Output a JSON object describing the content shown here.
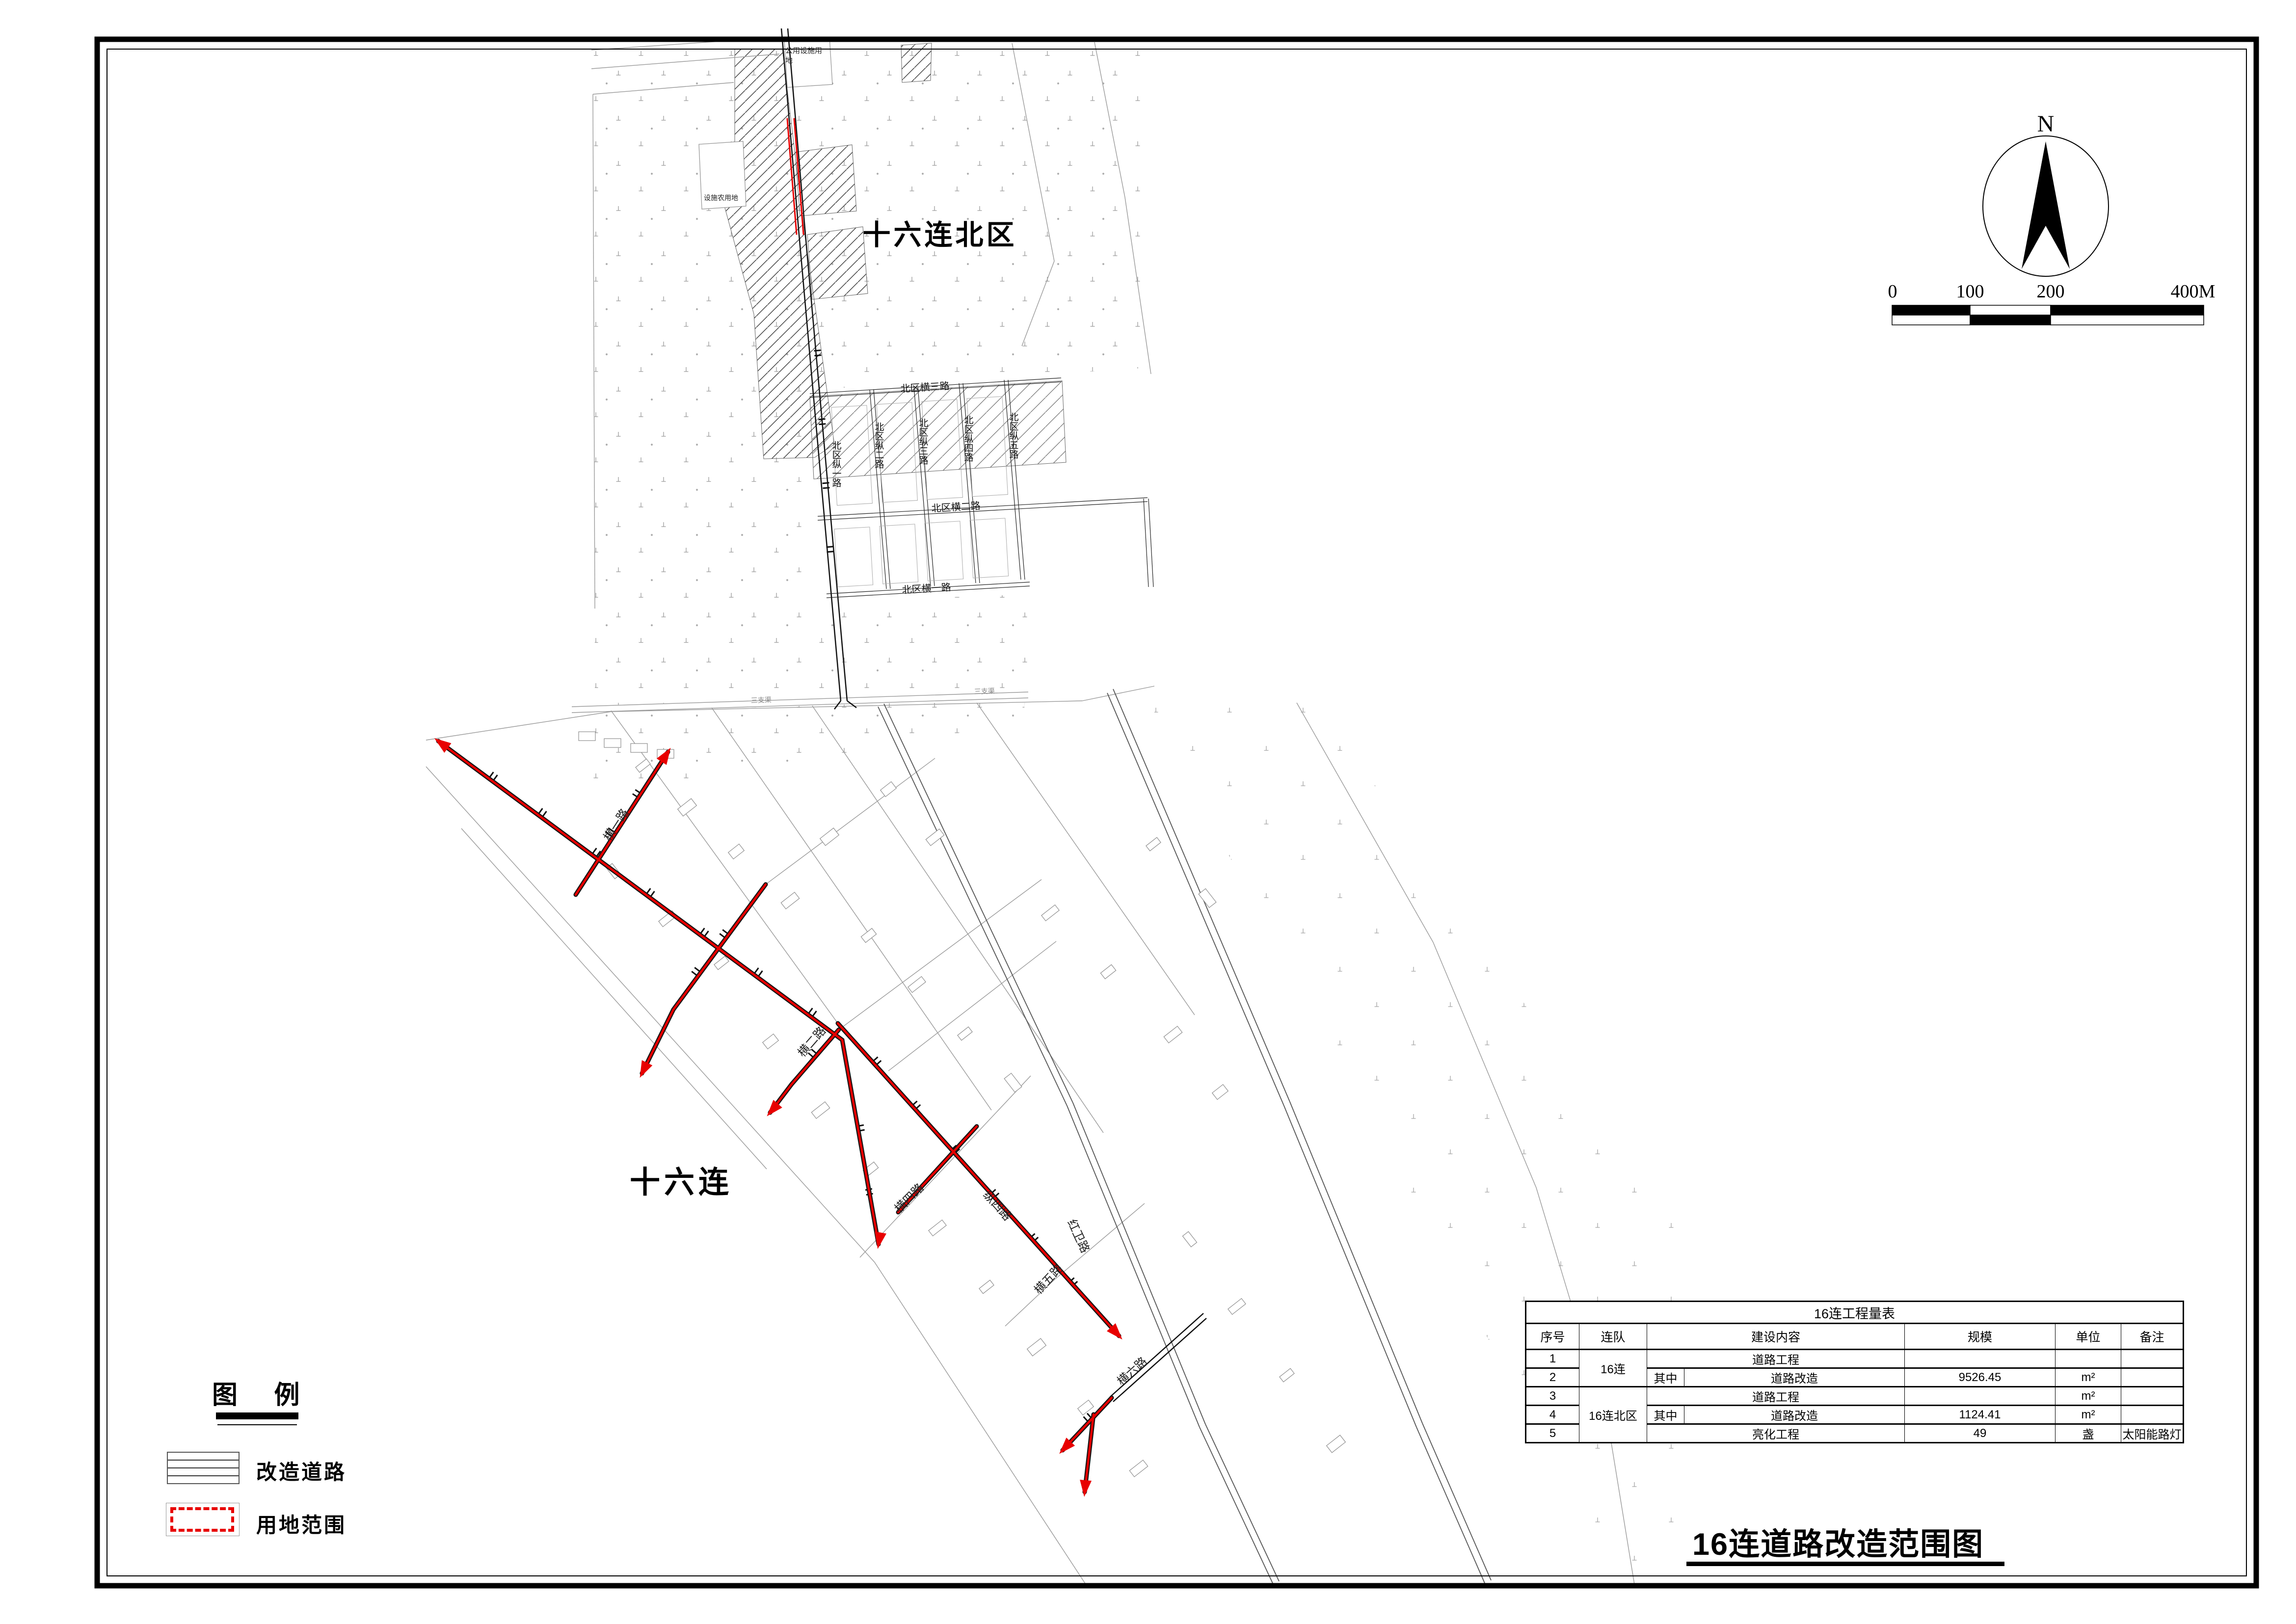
{
  "drawing": {
    "title": "16连道路改造范围图",
    "compass_n": "N",
    "scale_bar": {
      "ticks": [
        "0",
        "100",
        "200",
        "400M"
      ]
    },
    "region_labels": {
      "north_district": "十六连北区",
      "company": "十六连"
    },
    "map_labels": {
      "public_facility": "公用设施用地",
      "agri_facility": "设施农用地",
      "channel": "三支渠",
      "n_zong1": "北区纵一路",
      "n_zong2": "北区纵二路",
      "n_zong3": "北区纵三路",
      "n_zong4": "北区纵四路",
      "n_zong5": "北区纵五路",
      "n_heng1": "北区横一路",
      "n_heng2": "北区横二路",
      "n_heng3": "北区横三路",
      "s_heng1": "横一路",
      "s_heng2": "横二路",
      "s_heng4": "横四路",
      "s_heng5": "横五路",
      "s_heng6": "横六路",
      "s_zong4": "纵四路",
      "hongwei": "红卫路"
    },
    "legend": {
      "title": "图 例",
      "items": [
        {
          "label": "改造道路"
        },
        {
          "label": "用地范围"
        }
      ]
    },
    "colors": {
      "highlight": "#e80000",
      "line": "#000000",
      "gray": "#9a9a9a"
    }
  },
  "table": {
    "title": "16连工程量表",
    "headers": [
      "序号",
      "连队",
      "建设内容",
      "规模",
      "单位",
      "备注"
    ],
    "rows": [
      {
        "no": "1",
        "company": "16连",
        "sub": "",
        "content": "道路工程",
        "scale": "",
        "unit": "",
        "note": ""
      },
      {
        "no": "2",
        "company": "",
        "sub": "其中",
        "content": "道路改造",
        "scale": "9526.45",
        "unit": "m²",
        "note": ""
      },
      {
        "no": "3",
        "company": "16连北区",
        "sub": "",
        "content": "道路工程",
        "scale": "",
        "unit": "m²",
        "note": ""
      },
      {
        "no": "4",
        "company": "",
        "sub": "其中",
        "content": "道路改造",
        "scale": "1124.41",
        "unit": "m²",
        "note": ""
      },
      {
        "no": "5",
        "company": "",
        "sub": "",
        "content": "亮化工程",
        "scale": "49",
        "unit": "盏",
        "note": "太阳能路灯"
      }
    ]
  }
}
